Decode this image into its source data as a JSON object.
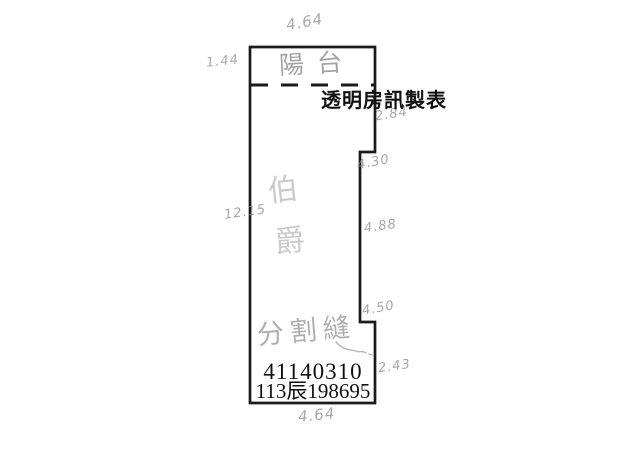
{
  "colors": {
    "wall": "#1b1b1b",
    "pencil": "#8f8f8f",
    "background": "#ffffff"
  },
  "plan": {
    "producer_label": "透明房訊製表",
    "balcony_label": "陽台",
    "interior_label_char1": "伯",
    "interior_label_char2": "爵",
    "partition_label": "分割縫",
    "serial_number": "41140310",
    "case_number": "113辰198695",
    "measurements": {
      "top_width": "4.64",
      "balcony_depth": "1.44",
      "left_height": "12.15",
      "right_top": "2.84",
      "right_upper": "4.30",
      "right_middle": "4.88",
      "right_lower": "4.50",
      "right_bottom": "2.43",
      "bottom_width": "4.64"
    }
  }
}
